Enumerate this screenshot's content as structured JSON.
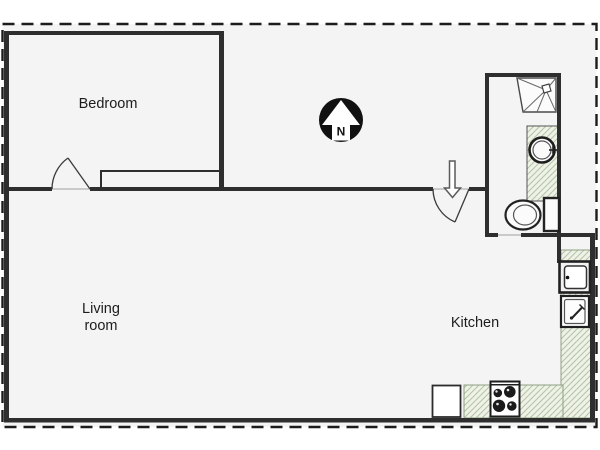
{
  "rooms": {
    "bedroom": {
      "label": "Bedroom"
    },
    "living_room": {
      "line1": "Living",
      "line2": "room"
    },
    "kitchen": {
      "label": "Kitchen"
    }
  },
  "compass": {
    "north_label": "N"
  },
  "fixtures": {
    "bathroom": [
      "shower",
      "sink",
      "vanity-counter",
      "toilet"
    ],
    "kitchen": [
      "refrigerator",
      "sink",
      "counter",
      "stove",
      "dishwasher"
    ]
  },
  "colors": {
    "wall": "#2e2e2e",
    "floor": "#f4f4f4",
    "page_bg": "#ffffff",
    "border_dash": "#1c1c1c",
    "hatch_bg": "#eef2e7",
    "hatch_line": "#b7c5aa",
    "hatch_edge": "#8fa083",
    "fixture_dark": "#1d1d1d",
    "fixture_mid": "#555555",
    "label_text": "#1c1c1c",
    "compass_bg": "#111111",
    "arrow_outline": "#5a5a5a"
  }
}
